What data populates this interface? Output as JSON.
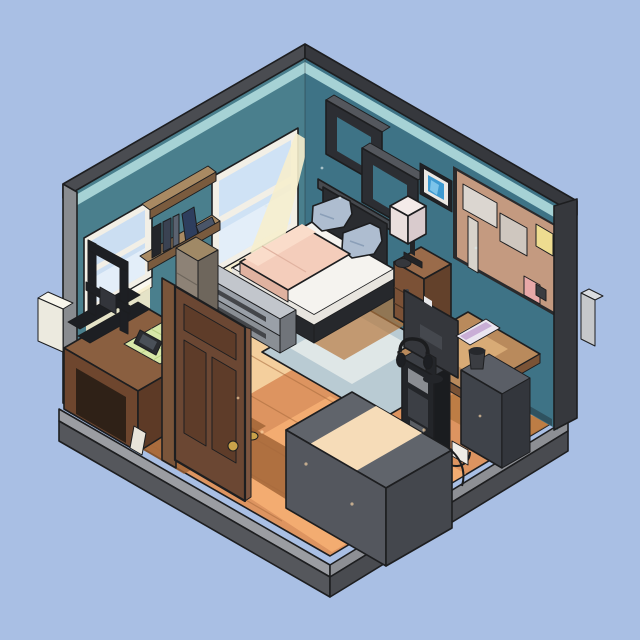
{
  "scene": {
    "title": "Isometric bedroom illustration",
    "style": "flat cartoon cutaway room, two teal walls, warm wood floor, sunlight from two windows",
    "objects": [
      "left-wall window",
      "back window with light beam",
      "wall shelves with books",
      "black cube shelves",
      "framed blue picture",
      "cork board with pinned papers",
      "bed with dark frame",
      "headboard",
      "two blue pillows",
      "folded pink blanket",
      "under-bed storage drawers",
      "small shelf tower",
      "nightstand with cube lamp",
      "blue rug",
      "computer desk",
      "monitor seen from behind",
      "keyboard",
      "mug",
      "headphones",
      "PC tower",
      "under-desk cabinet",
      "gray dresser",
      "open wooden door with brass knob",
      "door frame",
      "work desk with 3D printer",
      "green cutting mat",
      "power outlets",
      "exterior window sills",
      "plank floor"
    ]
  },
  "palette": {
    "bg": "#a9bfe4",
    "ink": "#1d1e20",
    "trimDark": "#4a4c51",
    "trimDarker": "#36383d",
    "capGray": "#898c90",
    "platBevelL": "#9b9da2",
    "platBevelR": "#8d8f94",
    "platFaceL": "#55575c",
    "platFaceR": "#494b50",
    "floorBase": "#dd9460",
    "floorBright": "#f3ad72",
    "floorCream": "#f8d9a8",
    "floorShadow": "#9e6134",
    "floorShadow2": "#b5773f",
    "underBed": "#c07c48",
    "plank": "#a56a3c",
    "wallL": "#4a7f8d",
    "wallR": "#3e7386",
    "wallBand": "#a6d2d5",
    "wallSkirt": "#2f5260",
    "cream": "#f6eecd",
    "winFrame": "#f2efe6",
    "glass": "#cbdef2",
    "glass2": "#cfe2f5",
    "glassLow": "#e3eef9",
    "sillLight": "#fbf8ee",
    "shelfFront": "#7a5b3e",
    "shelfTop": "#a98a63",
    "book1": "#23252a",
    "book2": "#3a4252",
    "book3": "#5a6270",
    "book4": "#2e3e5e",
    "book5": "#4a5568",
    "cube": "#2c2e33",
    "cubeBevel": "#54575d",
    "frameBlack": "#202226",
    "frameMat": "#eae8e4",
    "art": "#3d9ad1",
    "artLight": "#7cc4ea",
    "cork": "#c49a80",
    "corkBorder": "#2a2a2c",
    "paperWhite": "#dbd6d0",
    "paperStrip": "#d8d3cb",
    "paperGray": "#cfc7bf",
    "paperYellow": "#eedc90",
    "paperPink": "#e8a8a8",
    "outletDark": "#3a3c40",
    "outletWhite": "#efece6",
    "headCap": "#46494e",
    "headFace": "#2a2c30",
    "mattressTop": "#f5f3ef",
    "mattressSide": "#e8e5df",
    "bedFrame": "#26282c",
    "pillow": "#aebdd0",
    "pillowShade": "#8b9fb8",
    "blanket": "#f4cdbb",
    "blanketLight": "#fadcca",
    "blanketSide": "#e0b2a0",
    "drawerTop": "#c2c6cc",
    "drawerFace1": "#9aa0a8",
    "drawerFace2": "#8a8f95",
    "drawerSide": "#70747a",
    "handle": "#44464a",
    "towerTop": "#a08966",
    "towerFace": "#8d8276",
    "towerSide": "#6e665c",
    "nsTop": "#9a6b4a",
    "nsFront": "#7b5136",
    "nsSide": "#63412b",
    "nsLine": "#4a3322",
    "dish": "#35373c",
    "lampTop": "#f4ebe9",
    "lampL": "#eadfdd",
    "lampR": "#d9cbcd",
    "lampStem": "#232427",
    "rug": "#b9cbd3",
    "rugLit": "#e3eae9",
    "deskTop": "#b98a5c",
    "deskLit": "#dcae79",
    "deskFront": "#7a5336",
    "deskTopL": "#8a5f40",
    "deskFrontL": "#6e462e",
    "deskSideL": "#5d3a26",
    "deskInset": "#2f2117",
    "monitor": "#35373c",
    "monitorLabel": "#e8e8ea",
    "monitorVent": "#45484e",
    "kbBase": "#eae6f0",
    "kbKeys": "#c9aed6",
    "cupDark": "#3b3d42",
    "cupTop": "#26282c",
    "pcFace": "#232529",
    "pcSide": "#1a1c1f",
    "pcInner1": "#8a8d92",
    "pcInner2": "#3c3f45",
    "pcInner3": "#5a5e64",
    "cabTop": "#5a5e66",
    "cabFace": "#3f434a",
    "cabSide": "#33363c",
    "drTop": "#60646b",
    "drLit": "#f6dcb8",
    "drFace": "#54575e",
    "drSide": "#44474d",
    "doorFace": "#6b4733",
    "doorEdge": "#7d5540",
    "doorPanel": "#5e3c29",
    "doorFrame": "#7a553a",
    "knobGold": "#c9a24a",
    "printer": "#1d1f23",
    "printerLight": "#33353b",
    "mat": "#d8e8a8",
    "matGrid": "#b9d184",
    "device": "#2a2c30",
    "deviceScreen": "#4a5058",
    "paperFloor": "#e8e4da",
    "extWhiteFace": "#eceadf",
    "extWhiteTop": "#f8f6ec",
    "extGrayFace": "#c6c8cb",
    "extGrayTop": "#dadce0",
    "cable": "#1c1d1f",
    "speckWarm": "#ffd9a8",
    "speckCool": "#dfeaea"
  }
}
